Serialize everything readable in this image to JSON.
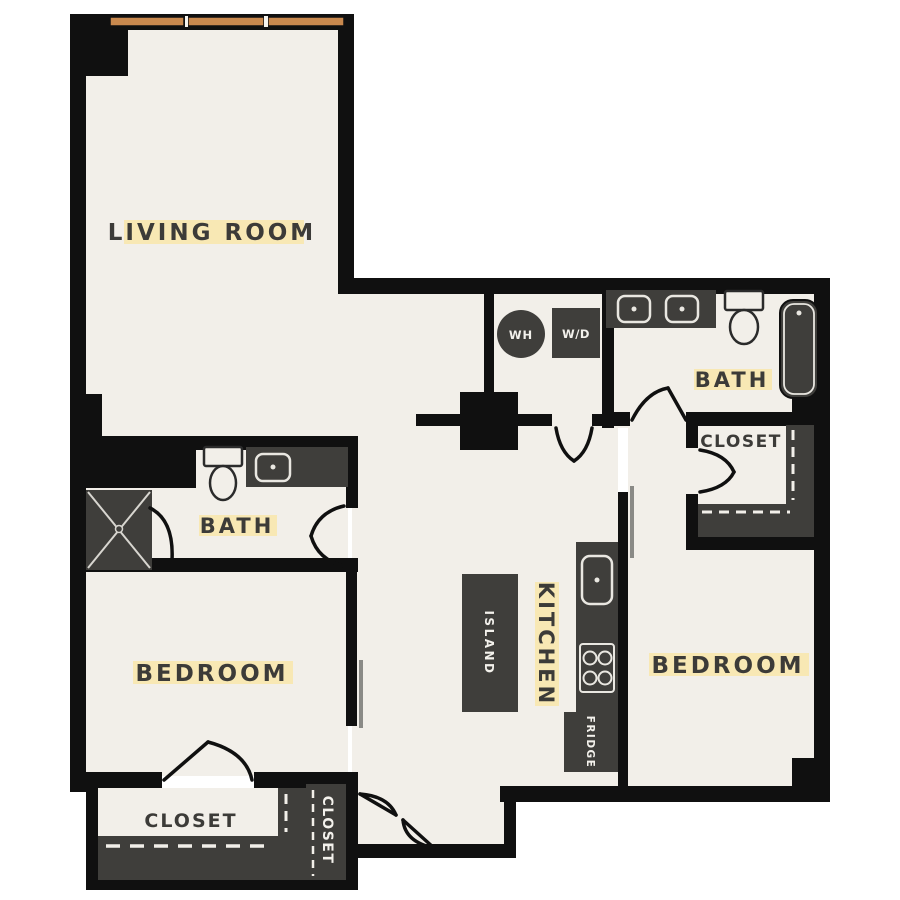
{
  "plan": {
    "rooms": {
      "living_room": {
        "label": "LIVING ROOM"
      },
      "bath_upper": {
        "label": "BATH"
      },
      "closet_upper": {
        "label": "CLOSET"
      },
      "bedroom_right": {
        "label": "BEDROOM"
      },
      "kitchen": {
        "label": "KITCHEN"
      },
      "bath_left": {
        "label": "BATH"
      },
      "bedroom_left": {
        "label": "BEDROOM"
      },
      "closet_bottom": {
        "label": "CLOSET"
      },
      "closet_bottom_small": {
        "label": "CLOSET"
      }
    },
    "appliances": {
      "water_heater": {
        "label": "WH"
      },
      "washer_dryer": {
        "label": "W/D"
      },
      "island": {
        "label": "ISLAND"
      },
      "fridge": {
        "label": "FRIDGE"
      }
    },
    "windows": {
      "panes": 3
    },
    "colors": {
      "wall": "#101010",
      "floor": "#f2efe9",
      "fixture": "#3f3e3b",
      "window": "#c9894e",
      "label": "#3c3b38",
      "label_highlight": "#f8e8b4",
      "label_on_dark": "#f3f1ec"
    }
  }
}
